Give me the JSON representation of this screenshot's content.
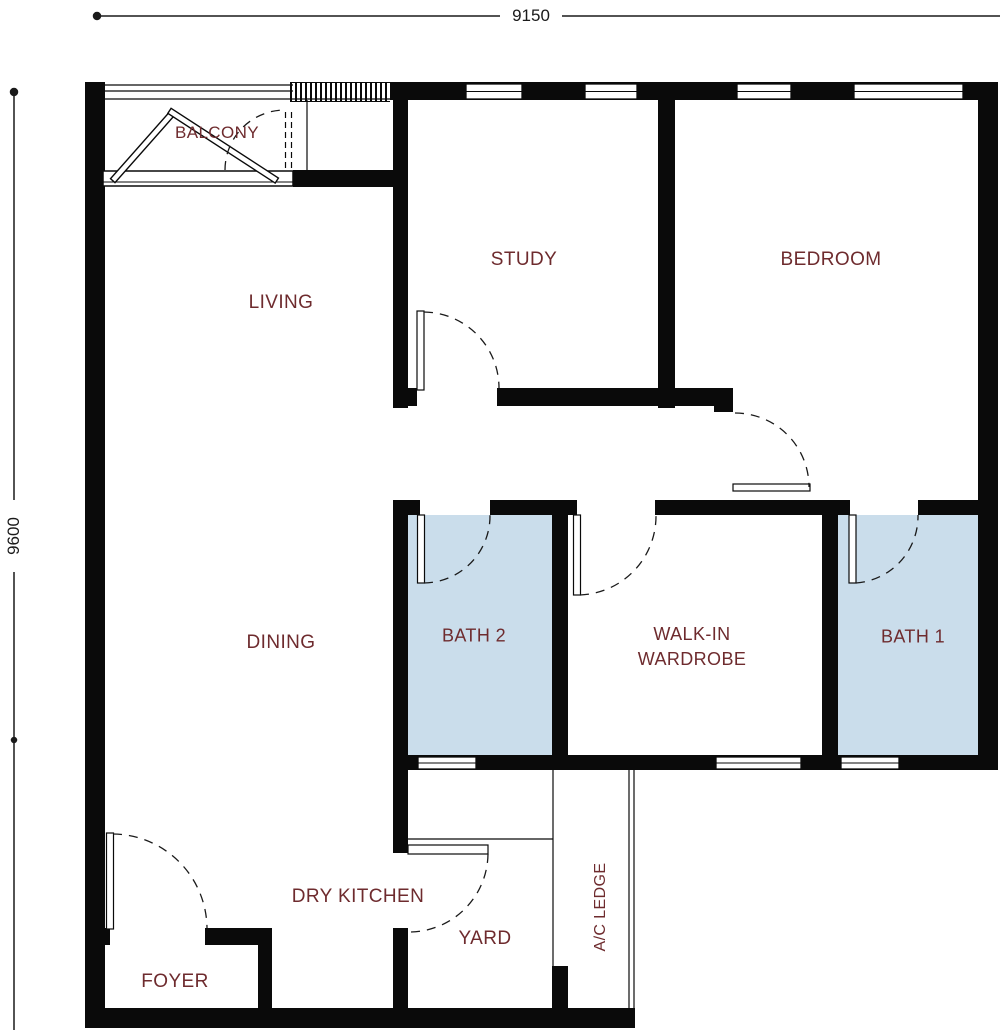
{
  "colors": {
    "wall": "#0a0a0a",
    "label": "#6e2b2e",
    "bath_fill": "#caddeb",
    "line": "#1a1a1a"
  },
  "dimensions": {
    "width_label": "9150",
    "height_label": "9600"
  },
  "rooms": [
    {
      "id": "balcony",
      "label": "BALCONY"
    },
    {
      "id": "living",
      "label": "LIVING"
    },
    {
      "id": "study",
      "label": "STUDY"
    },
    {
      "id": "bedroom",
      "label": "BEDROOM"
    },
    {
      "id": "dining",
      "label": "DINING"
    },
    {
      "id": "bath-2",
      "label": "BATH 2"
    },
    {
      "id": "walk-in-wardrobe",
      "label_line1": "WALK-IN",
      "label_line2": "WARDROBE"
    },
    {
      "id": "bath-1",
      "label": "BATH 1"
    },
    {
      "id": "dry-kitchen",
      "label": "DRY KITCHEN"
    },
    {
      "id": "yard",
      "label": "YARD"
    },
    {
      "id": "ac-ledge",
      "label": "A/C LEDGE"
    },
    {
      "id": "foyer",
      "label": "FOYER"
    }
  ]
}
